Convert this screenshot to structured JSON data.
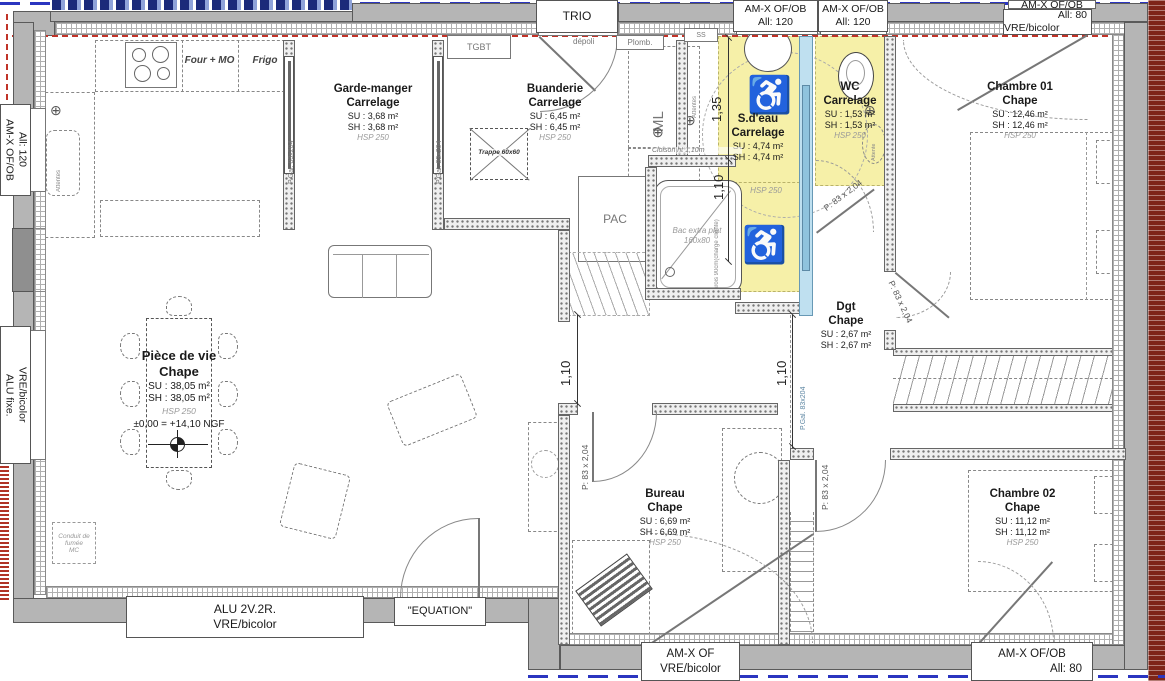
{
  "rooms": {
    "piece_de_vie": {
      "name": "Pièce de vie",
      "finish": "Chape",
      "su": "SU : 38,05 m²",
      "sh": "SH : 38,05 m²",
      "hsp": "HSP 250",
      "level": "±0,00 = +14,10 NGF"
    },
    "garde_manger": {
      "name": "Garde-manger",
      "finish": "Carrelage",
      "su": "SU : 3,68 m²",
      "sh": "SH : 3,68 m²",
      "hsp": "HSP 250"
    },
    "buanderie": {
      "name": "Buanderie",
      "finish": "Carrelage",
      "su": "SU : 6,45 m²",
      "sh": "SH : 6,45 m²",
      "hsp": "HSP 250"
    },
    "sdeau": {
      "name": "S.d'eau",
      "finish": "Carrelage",
      "su": "SU : 4,74 m²",
      "sh": "SH : 4,74 m²",
      "hsp": "HSP 250"
    },
    "wc": {
      "name": "WC",
      "finish": "Carrelage",
      "su": "SU : 1,53 m²",
      "sh": "SH : 1,53 m²",
      "hsp": "HSP 250"
    },
    "chambre01": {
      "name": "Chambre 01",
      "finish": "Chape",
      "su": "SU : 12,46 m²",
      "sh": "SH : 12,46 m²",
      "hsp": "HSP 250"
    },
    "dgt": {
      "name": "Dgt",
      "finish": "Chape",
      "su": "SU : 2,67 m²",
      "sh": "SH : 2,67 m²"
    },
    "bureau": {
      "name": "Bureau",
      "finish": "Chape",
      "su": "SU : 6,69 m²",
      "sh": "SH : 6,69 m²",
      "hsp": "HSP 250"
    },
    "chambre02": {
      "name": "Chambre 02",
      "finish": "Chape",
      "su": "SU : 11,12 m²",
      "sh": "SH : 11,12 m²",
      "hsp": "HSP 250"
    }
  },
  "window_labels": {
    "trio": "TRIO",
    "top_sdeau": {
      "l1": "AM-X OF/OB",
      "l2": "All: 120"
    },
    "top_wc": {
      "l1": "AM-X OF/OB",
      "l2": "All: 120"
    },
    "top_right_cut": "AM-X OF/OB",
    "top_chambre01": {
      "l1": "All: 80",
      "l2": "VRE/bicolor"
    },
    "left_kitchen": {
      "l1": "AM-X OF/OB",
      "l2": "All: 120"
    },
    "left_living": {
      "l1": "ALU fixe.",
      "l2": "VRE/bicolor"
    },
    "bottom_living": {
      "l1": "ALU 2V.2R.",
      "l2": "VRE/bicolor"
    },
    "bottom_equation": "\"EQUATION\"",
    "bottom_bureau": {
      "l1": "AM-X OF",
      "l2": "VRE/bicolor"
    },
    "bottom_chambre02": {
      "l1": "AM-X OF/OB",
      "l2": "All: 80"
    }
  },
  "equipment": {
    "four_mo": "Four + MO",
    "frigo": "Frigo",
    "tgbt": "TGBT",
    "depoli": "dépoli",
    "plomb": "Plomb.",
    "ss": "SS",
    "ml": "ML",
    "congel": "Congél.",
    "pac": "PAC",
    "attentes": "Attentes",
    "attente": "Attente",
    "trappe": "Trappe 60x60",
    "bac_l1": "Bac extra plat",
    "bac_l2": "160x80",
    "cloison": "Cloison ht 1,10m",
    "parois": "Parois 90cm(charge cliente)",
    "conduit_l1": "Conduit de fumée",
    "conduit_l2": "MC",
    "hsp_lower": "HSP 250"
  },
  "doors": {
    "pgal": "P.Gal. 83x204",
    "p83": "P: 83 x 2,04"
  },
  "dimensions": {
    "d135": "1,35",
    "d110": "1,10"
  },
  "icons": {
    "wheelchair": "♿",
    "position_marker": "⊕"
  },
  "colors": {
    "accent_yellow": "#f6f0a8",
    "door_blue": "#bfe0f0",
    "wall_gray": "#b5b5b5",
    "marker_red": "#c03328",
    "line_blue": "#2b35c0",
    "brick_red": "#7e2418"
  }
}
